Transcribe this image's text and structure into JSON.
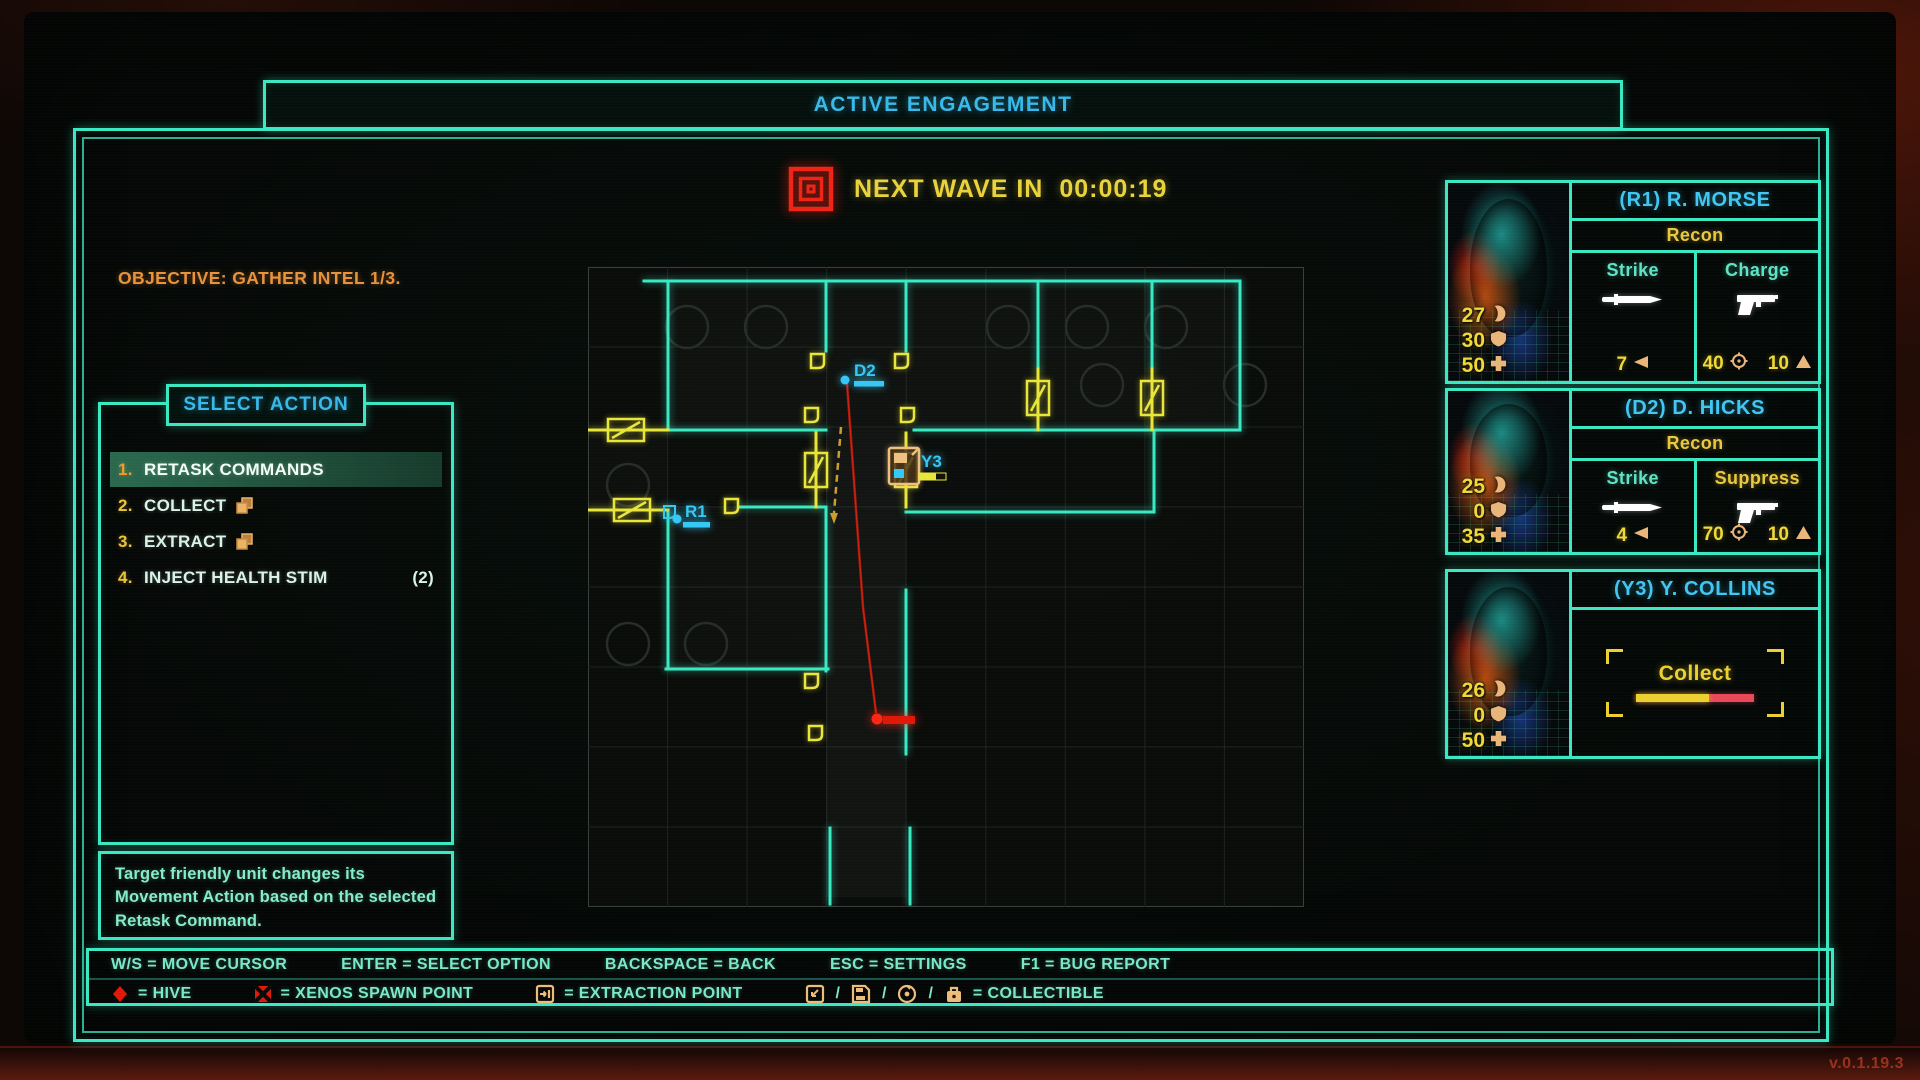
{
  "colors": {
    "teal": "#3ae8c2",
    "cyan": "#3cc2ef",
    "yellow": "#eed23c",
    "orange": "#eab578",
    "red": "#e82818"
  },
  "header": {
    "title": "ACTIVE ENGAGEMENT"
  },
  "wave": {
    "label": "NEXT WAVE IN",
    "time": "00:00:19"
  },
  "objective": "OBJECTIVE: GATHER INTEL 1/3.",
  "action_menu": {
    "title": "SELECT ACTION",
    "items": [
      {
        "number": "1.",
        "label": "RETASK COMMANDS",
        "selected": true
      },
      {
        "number": "2.",
        "label": "COLLECT",
        "icon": "collectible-icon"
      },
      {
        "number": "3.",
        "label": "EXTRACT",
        "icon": "collectible-icon"
      },
      {
        "number": "4.",
        "label": "INJECT HEALTH STIM",
        "count": "(2)"
      }
    ],
    "description": "Target friendly unit changes its Movement Action based on the selected Retask Command."
  },
  "map": {
    "units": [
      {
        "id": "D2"
      },
      {
        "id": "R1"
      },
      {
        "id": "Y3"
      }
    ],
    "enemy_color": "#ff2515",
    "unit_color": "#35c8f5"
  },
  "squad": [
    {
      "name": "(R1) R. MORSE",
      "class": "Recon",
      "stats": [
        {
          "value": "27",
          "icon": "claw-icon"
        },
        {
          "value": "30",
          "icon": "shield-icon"
        },
        {
          "value": "50",
          "icon": "health-icon"
        }
      ],
      "abilities": [
        {
          "name": "Strike",
          "icon": "knife-icon",
          "ammo": "7"
        },
        {
          "name": "Charge",
          "icon": "gun-icon",
          "accuracy": "40",
          "power": "10"
        }
      ]
    },
    {
      "name": "(D2) D. HICKS",
      "class": "Recon",
      "stats": [
        {
          "value": "25",
          "icon": "claw-icon"
        },
        {
          "value": "0",
          "icon": "shield-icon"
        },
        {
          "value": "35",
          "icon": "health-icon"
        }
      ],
      "abilities": [
        {
          "name": "Strike",
          "icon": "knife-icon",
          "ammo": "4"
        },
        {
          "name": "Suppress",
          "icon": "gun-icon",
          "accuracy": "70",
          "power": "10"
        }
      ]
    },
    {
      "name": "(Y3) Y. COLLINS",
      "stats": [
        {
          "value": "26",
          "icon": "claw-icon"
        },
        {
          "value": "0",
          "icon": "shield-icon"
        },
        {
          "value": "50",
          "icon": "health-icon"
        }
      ],
      "action": {
        "label": "Collect",
        "progress_pct": 62
      }
    }
  ],
  "hints": {
    "controls": [
      "W/S = MOVE CURSOR",
      "ENTER = SELECT OPTION",
      "BACKSPACE = BACK",
      "ESC = SETTINGS",
      "F1 = BUG REPORT"
    ],
    "legend": [
      {
        "icon": "hive-icon",
        "label": "= HIVE"
      },
      {
        "icon": "xenos-spawn-icon",
        "label": "= XENOS SPAWN POINT"
      },
      {
        "icon": "extraction-icon",
        "label": "= EXTRACTION POINT"
      },
      {
        "icons": [
          "save-arrow-icon",
          "floppy-icon",
          "disc-icon",
          "case-icon"
        ],
        "separator": "/",
        "label": "= COLLECTIBLE"
      }
    ]
  },
  "version": "v.0.1.19.3"
}
